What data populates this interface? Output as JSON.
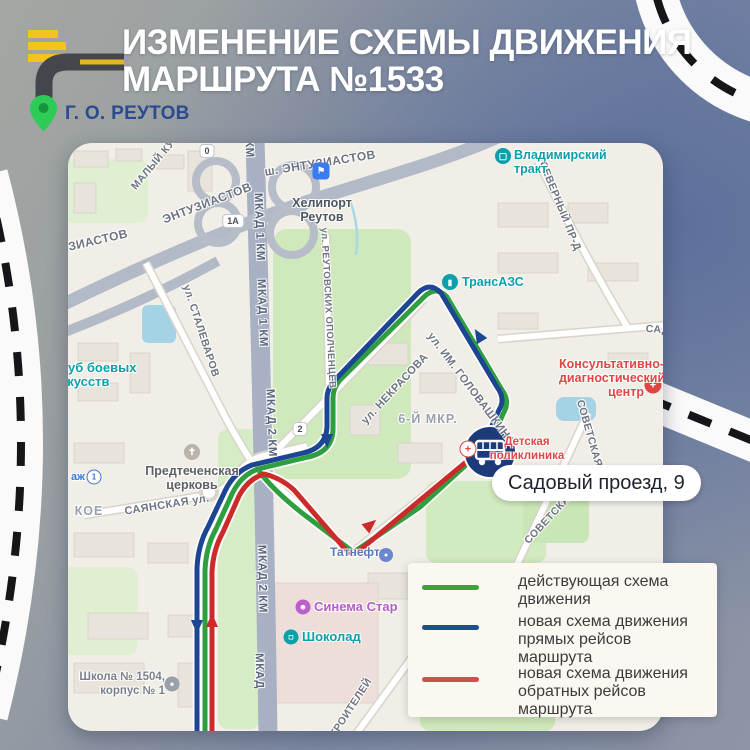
{
  "header": {
    "title_line1": "ИЗМЕНЕНИЕ СХЕМЫ ДВИЖЕНИЯ",
    "title_line2": "МАРШРУТА №1533",
    "location": "Г. О. РЕУТОВ"
  },
  "colors": {
    "route_current": "#2f9e3f",
    "route_new_forward": "#1c4593",
    "route_new_return": "#cc2b2b",
    "legend_green": "#3aa23f",
    "legend_blue": "#1f4e8e",
    "legend_red": "#d14f4f",
    "pin_green": "#2ecc56",
    "location_text": "#2a4b8d",
    "logo_yellow": "#f4c41d",
    "logo_dark": "#43474c"
  },
  "map": {
    "streets": {
      "maly_ku": "МАЛЫЙ КУ",
      "entuz_top": "ш. ЭНТУЗИАСТОВ",
      "entuz_left": "ЭНТУЗИАСТОВ",
      "entuz_frag": "ЗИАСТОВ",
      "km_frag": "КМ",
      "mkad1km": "МКАД 1 КМ",
      "mkad2km": "МКАД 2 КМ",
      "mkad": "МКАД",
      "severny": "СЕВЕРНЫЙ ПР-Д",
      "reutovskih": "ул. РЕУТОВСКИХ ОПОЛЧЕНЦЕВ",
      "stalevarov": "ул. СТАЛЕВАРОВ",
      "nekrasova": "ул. НЕКРАСОВА",
      "golovashkina": "ул. ИМ. ГОЛОВАШКИНА",
      "sado": "САДО",
      "sayanskaya": "САЯНСКАЯ ул.",
      "koe": "КОЕ",
      "sovetskaya_v": "СОВЕТСКАЯ ул.",
      "sovetskaya_d": "СОВЕТСКАЯ",
      "stroiteley": "СТРОИТЕЛЕЙ",
      "mkr6": "6-Й МКР."
    },
    "badges": {
      "b0": "0",
      "b1a": "1А",
      "b2": "2"
    },
    "poi": {
      "helipad": {
        "line1": "Хелипорт",
        "line2": "Реутов"
      },
      "vladimirsky": {
        "line1": "Владимирский",
        "line2": "тракт"
      },
      "transazs": {
        "label": "ТрансАЗС"
      },
      "klub": {
        "line1": "Клуб боевых",
        "line2": "искусств"
      },
      "detskaya": {
        "line1": "Детская",
        "line2": "поликлиника"
      },
      "kons": {
        "line1": "Консультативно-",
        "line2": "диагностический",
        "line3": "центр"
      },
      "predtech": {
        "line1": "Предтеченская",
        "line2": "церковь"
      },
      "tatneft": {
        "label": "Татнефть"
      },
      "cinema": {
        "label": "Синема Стар"
      },
      "shokolad": {
        "label": "Шоколад"
      },
      "school": {
        "line1": "Школа № 1504,",
        "line2": "корпус № 1"
      },
      "azh": {
        "label": "аж"
      }
    },
    "stop_callout": "Садовый проезд, 9"
  },
  "legend": {
    "items": [
      {
        "label": "действующая схема движения",
        "color": "#3aa23f"
      },
      {
        "label": "новая схема движения прямых рейсов маршрута",
        "color": "#1f4e8e"
      },
      {
        "label": "новая схема движения обратных рейсов маршрута",
        "color": "#d14f4f"
      }
    ]
  }
}
